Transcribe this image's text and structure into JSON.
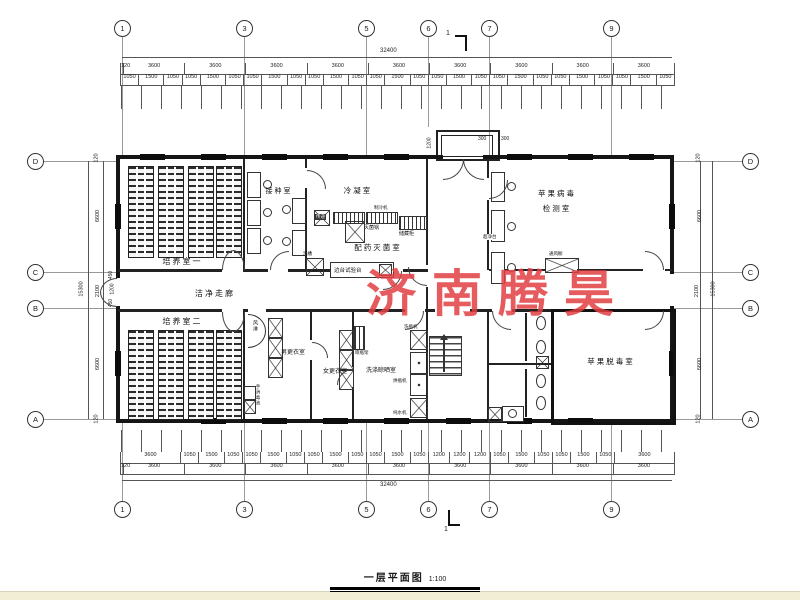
{
  "watermark": {
    "text": "济南腾昊",
    "color": "#e23f42"
  },
  "title_block": {
    "title": "一层平面图",
    "scale": "1:100"
  },
  "grid": {
    "top": [
      "1",
      "3",
      "5",
      "6",
      "7",
      "9"
    ],
    "bottom": [
      "1",
      "3",
      "5",
      "6",
      "7",
      "9"
    ],
    "left": [
      "D",
      "C",
      "B",
      "A"
    ],
    "right": [
      "D",
      "C",
      "B",
      "A"
    ]
  },
  "section_marks": {
    "top": "1",
    "bottom": "1"
  },
  "dimensions": {
    "top": {
      "total": "32400",
      "bays": [
        "120",
        "3600",
        "3600",
        "3600",
        "3600",
        "3600",
        "3600",
        "3600",
        "3600",
        "3600"
      ],
      "detail": [
        "1050",
        "1500",
        "1050",
        "1050",
        "1500",
        "1050",
        "1050",
        "1500",
        "1050",
        "1050",
        "1500",
        "1050",
        "1050",
        "1500",
        "1050",
        "1050",
        "1500",
        "1050",
        "1050",
        "1500",
        "1050",
        "1050",
        "1500",
        "1050",
        "1050",
        "1500",
        "1050"
      ]
    },
    "bottom": {
      "total": "32400",
      "detail": [
        "3600",
        "1050",
        "1500",
        "1050",
        "1050",
        "1500",
        "1050",
        "1050",
        "1500",
        "1050",
        "1050",
        "1500",
        "1050",
        "1200",
        "1200",
        "1200",
        "1050",
        "1500",
        "1050",
        "1050",
        "1500",
        "1050",
        "3600"
      ],
      "bays": [
        "120",
        "3600",
        "3600",
        "3600",
        "3600",
        "3600",
        "3600",
        "3600",
        "3600",
        "3600"
      ]
    },
    "left": {
      "edge_top": "120",
      "d_c": "6600",
      "c_b": "2100",
      "b_a": "6600",
      "edge_bottom": "120",
      "total": "15300",
      "inner_top": "450",
      "inner_mid": "1200",
      "inner_bottom": "450"
    },
    "right": {
      "edge_top": "120",
      "d_c": "6600",
      "c_b": "2100",
      "b_a": "6600",
      "edge_bottom": "120",
      "total": "15300"
    },
    "porch": {
      "depth": "1200",
      "w1": "300",
      "w2": "300"
    }
  },
  "rooms": {
    "culture1": "培养室一",
    "culture2": "培养室二",
    "inoculation": "接种室",
    "condensation": "冷凝室",
    "sterilization": "配药灭菌室",
    "corridor": "洁净走廊",
    "detection_line1": "苹果病毒",
    "detection_line2": "检测室",
    "detox": "苹果脱毒室",
    "men_changing": "男更衣室",
    "women_changing": "女更衣室",
    "washing": "洗涤晾晒室",
    "air_shower": "风淋",
    "hand_sanitizer": "手消毒池"
  },
  "equipment": {
    "pass_window": "传递",
    "sterilizer": "灭菌锅",
    "chiller": "制冷机",
    "storage_cabinet": "储藏柜",
    "sink": "洗槽",
    "side_bench": "边台试验台",
    "clean_bench": "超净台",
    "fume_hood": "通风橱",
    "bottle_washer": "洗瓶机",
    "bottle_dryer": "烘瓶机",
    "water_purifier": "纯水机",
    "drying_rack": "晾瓶架"
  }
}
